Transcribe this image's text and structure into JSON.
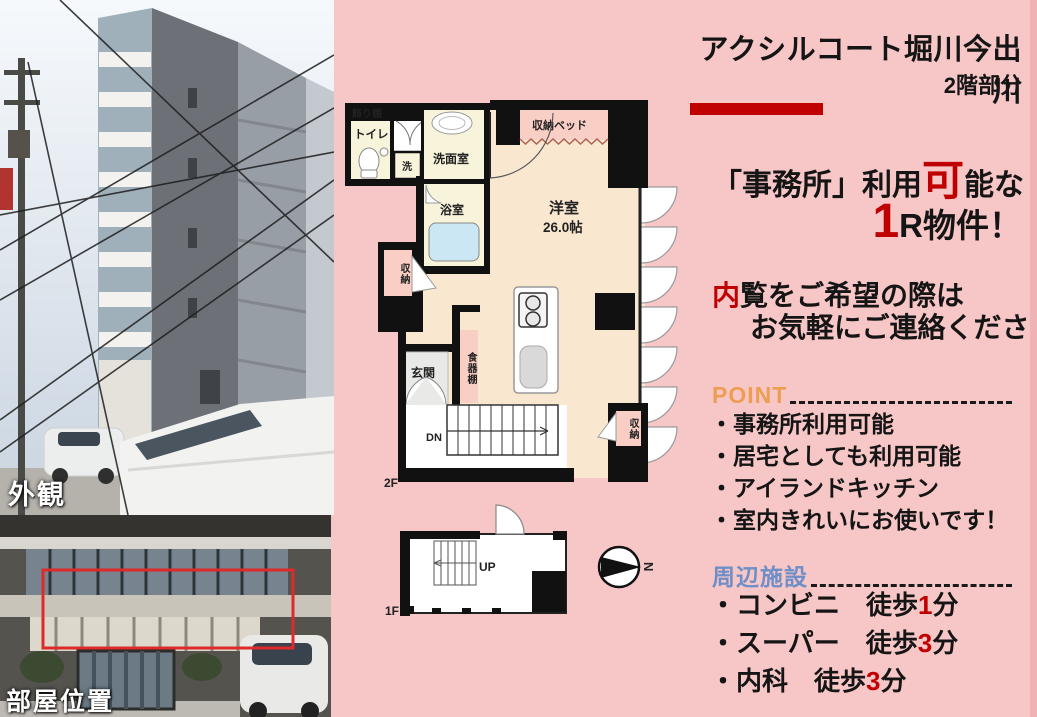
{
  "header": {
    "title": "アクシルコート堀川今出川",
    "subtitle": "2階部分"
  },
  "offer": {
    "line1_pre": "「事務所」利用",
    "line1_accent": "可",
    "line1_post": "能な",
    "line2_accent": "1",
    "line2_post": "R物件！"
  },
  "invite": {
    "line1_accent": "内",
    "line1_post": "覧をご希望の際は",
    "line2": "お気軽にご連絡ください！"
  },
  "point": {
    "heading": "POINT",
    "items": [
      "・事務所利用可能",
      "・居宅としても利用可能",
      "・アイランドキッチン",
      "・室内きれいにお使いです！"
    ]
  },
  "facilities": {
    "heading": "周辺施設",
    "items": [
      {
        "pre": "・コンビニ　徒歩",
        "num": "1",
        "post": "分"
      },
      {
        "pre": "・スーパー　徒歩",
        "num": "3",
        "post": "分"
      },
      {
        "pre": "・内科　徒歩",
        "num": "3",
        "post": "分"
      }
    ]
  },
  "photos": {
    "exterior_label": "外観",
    "location_label": "部屋位置"
  },
  "floorplan": {
    "labels": {
      "shelf": "飾り棚",
      "toilet": "トイレ",
      "washer": "洗",
      "powder_room": "洗面室",
      "bathroom": "浴室",
      "closet_left": "収納",
      "storage_bed": "収納ベッド",
      "main_room": "洋室",
      "main_room_size": "26.0帖",
      "cupboard": "食器棚",
      "entrance": "玄関",
      "stairs_down": "DN",
      "closet_right": "収納",
      "floor2": "2F",
      "floor1": "1F",
      "stairs_up": "UP",
      "compass_north": "N"
    }
  },
  "colors": {
    "background_pink": "#F7C6C6",
    "accent_red": "#C00000",
    "point_orange": "#ED9E53",
    "facility_blue": "#6E8EC8",
    "plan_cream": "#FAE7CF",
    "plan_pale_yellow": "#F8F4DC",
    "plan_pink": "#F9CEC5",
    "tub_blue": "#CBE7F4"
  }
}
